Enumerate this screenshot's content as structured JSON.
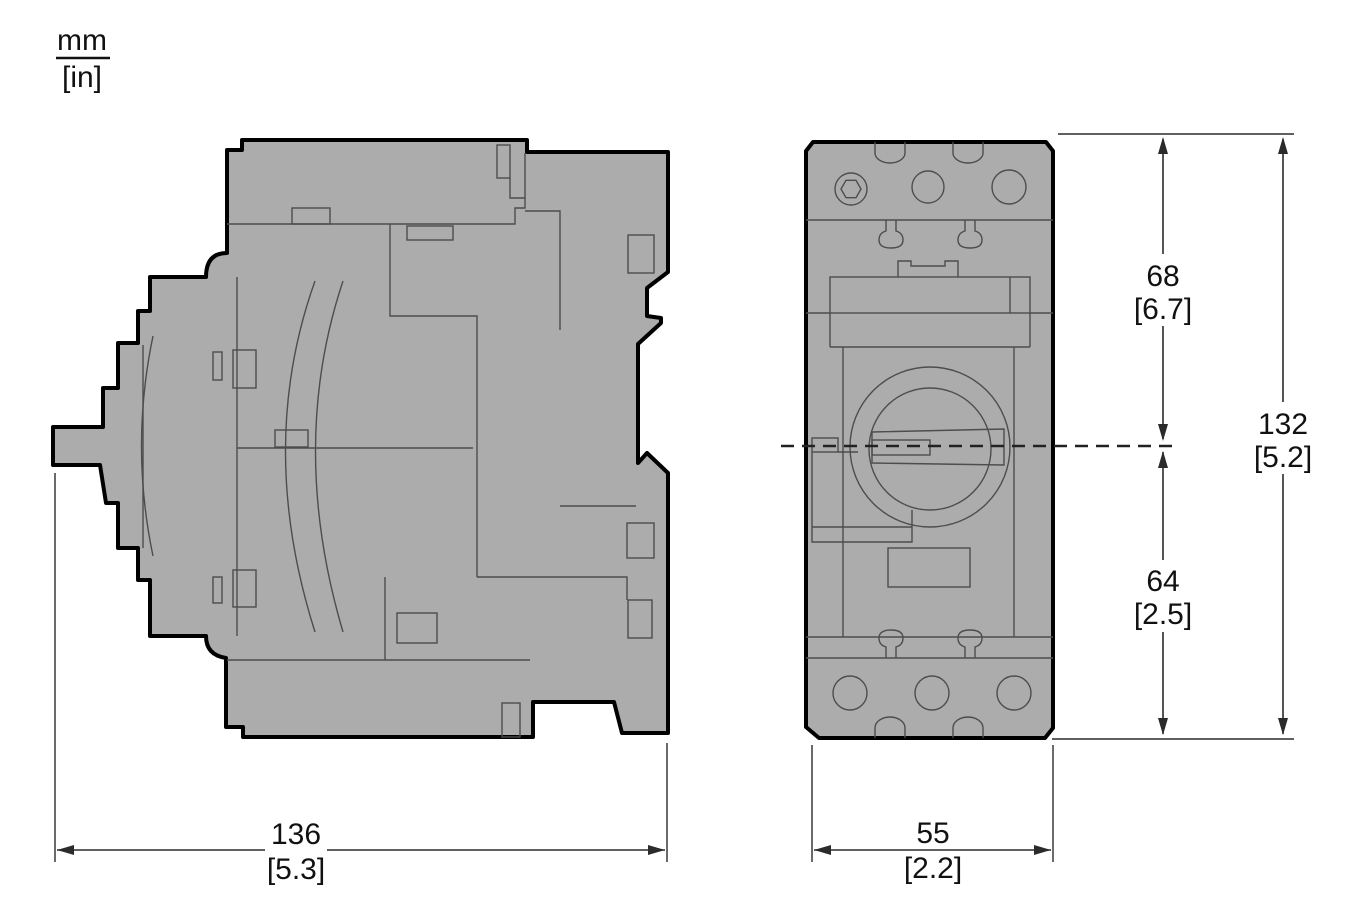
{
  "unit_label": {
    "top": "mm",
    "bottom": "[in]"
  },
  "dimensions": {
    "side_width": {
      "mm": "136",
      "in": "[5.3]"
    },
    "front_width": {
      "mm": "55",
      "in": "[2.2]"
    },
    "upper_height": {
      "mm": "68",
      "in": "[6.7]"
    },
    "lower_height": {
      "mm": "64",
      "in": "[2.5]"
    },
    "total_height": {
      "mm": "132",
      "in": "[5.2]"
    }
  },
  "views": {
    "side_view_name": "circuit-breaker-side-view",
    "front_view_name": "circuit-breaker-front-view"
  },
  "colors": {
    "body_fill": "#ACACAC",
    "outline": "#000000",
    "detail_line": "#4D4D4D",
    "dimension_line": "#2B2B2B",
    "background": "#FFFFFF"
  }
}
